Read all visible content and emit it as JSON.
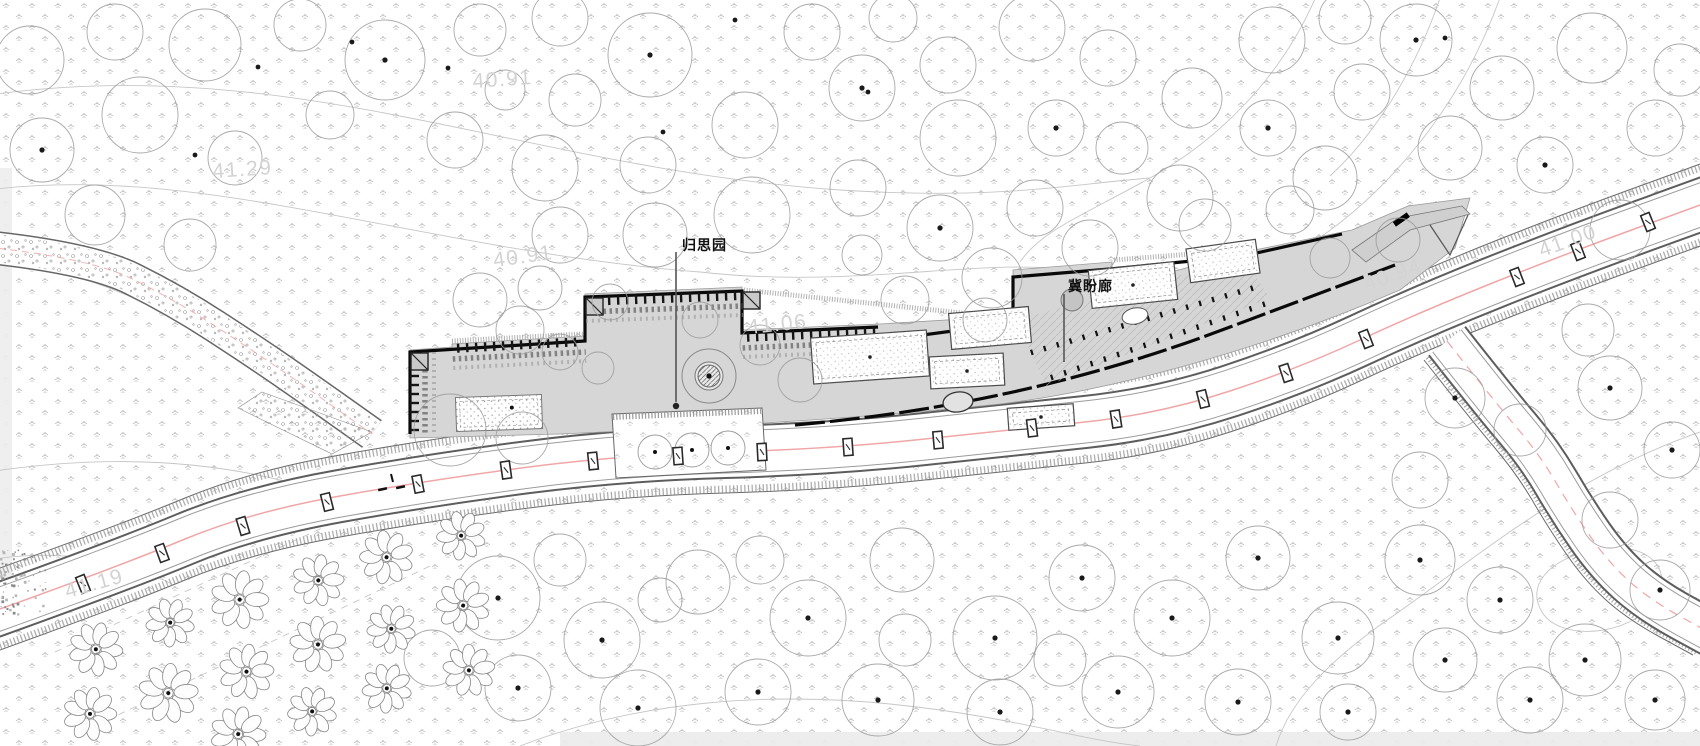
{
  "drawing": {
    "type": "architectural landscape site plan",
    "labels": {
      "garden": {
        "text": "归思园"
      },
      "corridor": {
        "text": "冀盼廊"
      }
    },
    "elevation_labels": [
      {
        "text": "41.29",
        "x": 243,
        "y": 176,
        "rot": -4
      },
      {
        "text": "40.91",
        "x": 503,
        "y": 86,
        "rot": -4
      },
      {
        "text": "40.91",
        "x": 524,
        "y": 263,
        "rot": -8
      },
      {
        "text": "41.06",
        "x": 778,
        "y": 331,
        "rot": -6
      },
      {
        "text": "40.94",
        "x": 1395,
        "y": 281,
        "rot": -20
      },
      {
        "text": "41.00",
        "x": 1570,
        "y": 247,
        "rot": -20
      },
      {
        "text": "41.19",
        "x": 96,
        "y": 590,
        "rot": -16
      }
    ],
    "colors": {
      "road_centerline": "#f0a6a6",
      "building_fill": "#d6d6d6",
      "wall": "#0a0a0a",
      "contour": "#c6c6c6",
      "tree_stroke": "#9a9a9a",
      "grass_mark": "#a8a8a8",
      "elevation_text": "#d3d3d3",
      "label_text": "#111111"
    }
  }
}
